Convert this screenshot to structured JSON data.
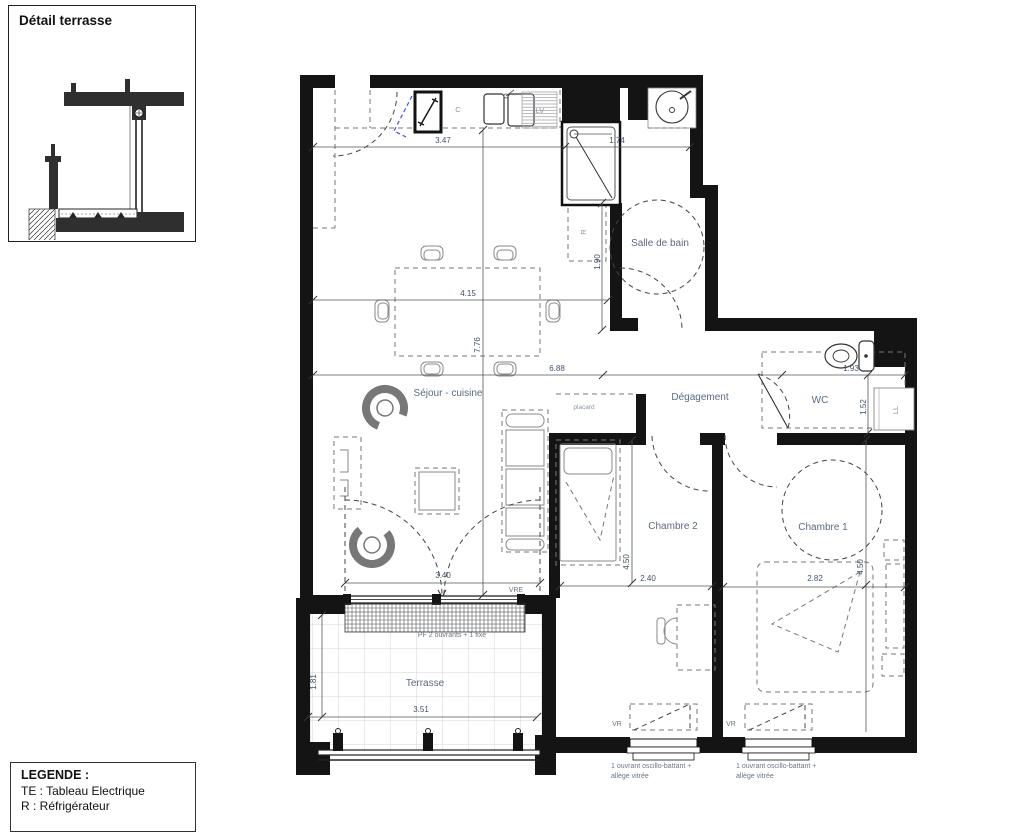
{
  "title_block": {
    "detail_title": "Détail terrasse"
  },
  "legend": {
    "title": "LEGENDE :",
    "items": [
      "TE : Tableau Electrique",
      "R : Réfrigérateur"
    ]
  },
  "rooms": {
    "sejour": "Séjour - cuisine",
    "salle_de_bain": "Salle de bain",
    "degagement": "Dégagement",
    "wc": "WC",
    "chambre2": "Chambre 2",
    "chambre1": "Chambre 1",
    "terrasse": "Terrasse",
    "placard": "placard"
  },
  "labels": {
    "c": "C",
    "lv": "LV",
    "r": "R",
    "ll": "LL"
  },
  "dimensions": {
    "kitchen_width": "3.47",
    "sdb_width": "1.74",
    "sdb_depth": "1.90",
    "table_width": "4.15",
    "sejour_height": "7.76",
    "sejour_width": "6.88",
    "wc_width": "1.93",
    "wc_depth": "1.52",
    "ch2_width": "2.40",
    "ch2_height": "4.50",
    "ch1_width": "2.82",
    "ch1_height": "4.50",
    "bay_width": "3.40",
    "terrasse_width": "3.51",
    "terrasse_depth": "1.81"
  },
  "annotations": {
    "vre": "VRE",
    "vr": "VR",
    "pf": "PF 2 ouvrants + 1 fixe",
    "note_line1": "1 ouvrant oscillo-battant +",
    "note_line2": "allège vitrée"
  }
}
